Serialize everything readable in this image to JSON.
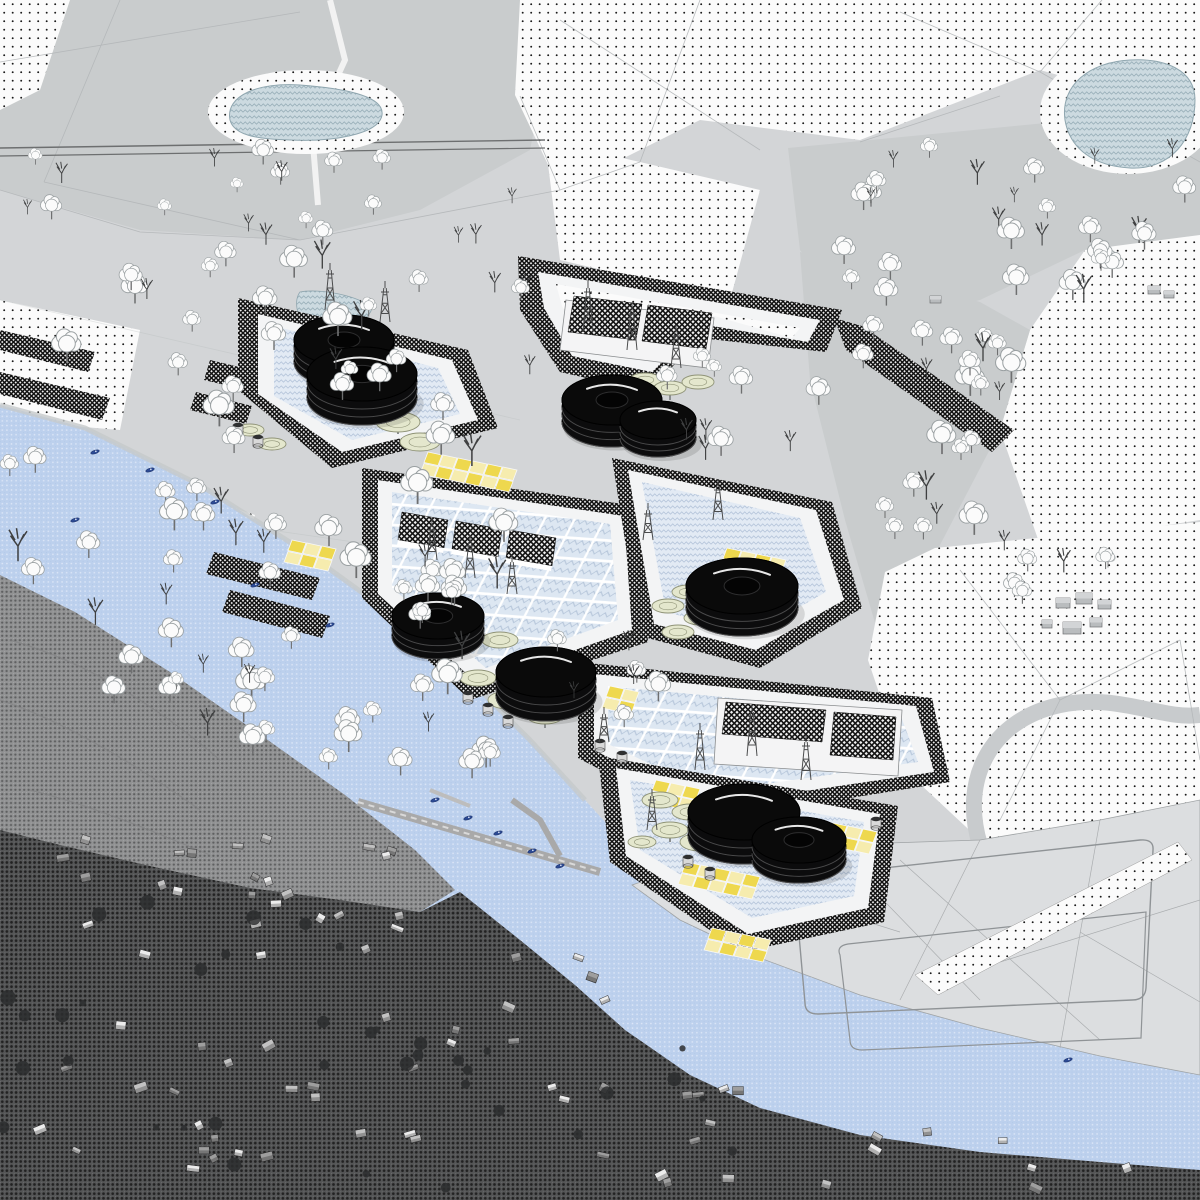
{
  "meta": {
    "kind": "architectural-masterplan-aerial-collage",
    "regions": [
      "drawn parkland with trees",
      "dotted meadow fields",
      "chevron-hatched ponds",
      "terraced process platforms with storage tanks",
      "blue overlaid river",
      "halftone aerial photograph of riverside town",
      "reclaimed polder fields with berms"
    ]
  },
  "colors": {
    "base": "#d3d5d7",
    "terrain": "#c9cccd",
    "terrainDark": "#bfc2c4",
    "field": "#dcdee0",
    "white": "#f4f4f5",
    "yellow1": "#eed84e",
    "yellow2": "#f6ecae",
    "padGreen": "#e4e7cd",
    "padStroke": "#8f9377",
    "tankBlack": "#0c0c0d",
    "boat": "#2c4a94",
    "houseLight": "#ececec",
    "houseMid": "#c2c2c2",
    "houseDark": "#9e9e9e",
    "shrub": "#2c2d2e",
    "mast": "#4b4c4d"
  },
  "scene": {
    "tree_zones": [
      {
        "x": 15,
        "y": 150,
        "w": 500,
        "h": 90,
        "n": 20,
        "bare": 0.45,
        "s": 0.75
      },
      {
        "x": 0,
        "y": 250,
        "w": 540,
        "h": 150,
        "n": 26,
        "bare": 0.3,
        "s": 1.0
      },
      {
        "x": 0,
        "y": 405,
        "w": 520,
        "h": 175,
        "n": 26,
        "bare": 0.25,
        "s": 1.1
      },
      {
        "x": 90,
        "y": 580,
        "w": 390,
        "h": 160,
        "n": 20,
        "bare": 0.3,
        "s": 1.05
      },
      {
        "x": 240,
        "y": 700,
        "w": 260,
        "h": 100,
        "n": 11,
        "bare": 0.2,
        "s": 1.0
      },
      {
        "x": 830,
        "y": 150,
        "w": 360,
        "h": 80,
        "n": 14,
        "bare": 0.5,
        "s": 0.85
      },
      {
        "x": 840,
        "y": 235,
        "w": 360,
        "h": 95,
        "n": 15,
        "bare": 0.25,
        "s": 0.95
      },
      {
        "x": 850,
        "y": 330,
        "w": 175,
        "h": 120,
        "n": 14,
        "bare": 0.2,
        "s": 1.05
      },
      {
        "x": 868,
        "y": 440,
        "w": 145,
        "h": 110,
        "n": 10,
        "bare": 0.15,
        "s": 1.05
      },
      {
        "x": 1000,
        "y": 560,
        "w": 170,
        "h": 50,
        "n": 6,
        "bare": 0.2,
        "s": 0.9
      },
      {
        "x": 660,
        "y": 360,
        "w": 170,
        "h": 95,
        "n": 10,
        "bare": 0.45,
        "s": 0.9
      },
      {
        "x": 545,
        "y": 640,
        "w": 150,
        "h": 130,
        "n": 7,
        "bare": 0.3,
        "s": 0.95
      },
      {
        "x": 150,
        "y": 640,
        "w": 120,
        "h": 90,
        "n": 6,
        "bare": 0.5,
        "s": 0.9
      }
    ],
    "tanks": [
      {
        "x": 344,
        "y": 340,
        "rx": 50,
        "ry": 25,
        "h": 22,
        "donut": true
      },
      {
        "x": 362,
        "y": 374,
        "rx": 55,
        "ry": 27,
        "h": 24,
        "donut": true
      },
      {
        "x": 612,
        "y": 400,
        "rx": 50,
        "ry": 25,
        "h": 22,
        "donut": true
      },
      {
        "x": 658,
        "y": 420,
        "rx": 38,
        "ry": 19,
        "h": 18,
        "donut": false
      },
      {
        "x": 438,
        "y": 616,
        "rx": 46,
        "ry": 23,
        "h": 20,
        "donut": true
      },
      {
        "x": 546,
        "y": 672,
        "rx": 50,
        "ry": 25,
        "h": 24,
        "donut": false
      },
      {
        "x": 742,
        "y": 586,
        "rx": 56,
        "ry": 28,
        "h": 22,
        "donut": true
      },
      {
        "x": 744,
        "y": 812,
        "rx": 56,
        "ry": 28,
        "h": 24,
        "donut": false
      },
      {
        "x": 799,
        "y": 840,
        "rx": 47,
        "ry": 23,
        "h": 20,
        "donut": true
      }
    ],
    "masts": [
      {
        "x": 330,
        "y": 310,
        "h": 40
      },
      {
        "x": 385,
        "y": 322,
        "h": 34
      },
      {
        "x": 588,
        "y": 332,
        "h": 44
      },
      {
        "x": 632,
        "y": 350,
        "h": 40
      },
      {
        "x": 676,
        "y": 368,
        "h": 36
      },
      {
        "x": 432,
        "y": 560,
        "h": 34
      },
      {
        "x": 470,
        "y": 578,
        "h": 36
      },
      {
        "x": 512,
        "y": 594,
        "h": 32
      },
      {
        "x": 648,
        "y": 540,
        "h": 30
      },
      {
        "x": 718,
        "y": 520,
        "h": 34
      },
      {
        "x": 700,
        "y": 770,
        "h": 40
      },
      {
        "x": 752,
        "y": 756,
        "h": 44
      },
      {
        "x": 806,
        "y": 780,
        "h": 38
      },
      {
        "x": 652,
        "y": 830,
        "h": 34
      },
      {
        "x": 604,
        "y": 742,
        "h": 28
      }
    ],
    "pads": [
      {
        "x": 372,
        "y": 400,
        "rx": 20,
        "ry": 9
      },
      {
        "x": 398,
        "y": 422,
        "rx": 22,
        "ry": 10
      },
      {
        "x": 420,
        "y": 442,
        "rx": 20,
        "ry": 9
      },
      {
        "x": 645,
        "y": 380,
        "rx": 16,
        "ry": 7
      },
      {
        "x": 670,
        "y": 388,
        "rx": 16,
        "ry": 7
      },
      {
        "x": 698,
        "y": 382,
        "rx": 16,
        "ry": 7
      },
      {
        "x": 500,
        "y": 640,
        "rx": 18,
        "ry": 8
      },
      {
        "x": 478,
        "y": 678,
        "rx": 18,
        "ry": 8
      },
      {
        "x": 508,
        "y": 700,
        "rx": 20,
        "ry": 9
      },
      {
        "x": 545,
        "y": 716,
        "rx": 18,
        "ry": 8
      },
      {
        "x": 688,
        "y": 592,
        "rx": 16,
        "ry": 7
      },
      {
        "x": 668,
        "y": 606,
        "rx": 16,
        "ry": 7
      },
      {
        "x": 700,
        "y": 618,
        "rx": 16,
        "ry": 7
      },
      {
        "x": 678,
        "y": 632,
        "rx": 16,
        "ry": 7
      },
      {
        "x": 660,
        "y": 800,
        "rx": 18,
        "ry": 8
      },
      {
        "x": 690,
        "y": 812,
        "rx": 18,
        "ry": 8
      },
      {
        "x": 670,
        "y": 830,
        "rx": 18,
        "ry": 8
      },
      {
        "x": 700,
        "y": 842,
        "rx": 20,
        "ry": 9
      },
      {
        "x": 642,
        "y": 842,
        "rx": 14,
        "ry": 6
      },
      {
        "x": 250,
        "y": 430,
        "rx": 14,
        "ry": 6
      },
      {
        "x": 272,
        "y": 444,
        "rx": 14,
        "ry": 6
      }
    ],
    "drums": [
      {
        "x": 468,
        "y": 700
      },
      {
        "x": 488,
        "y": 712
      },
      {
        "x": 508,
        "y": 724
      },
      {
        "x": 600,
        "y": 748
      },
      {
        "x": 622,
        "y": 760
      },
      {
        "x": 238,
        "y": 432
      },
      {
        "x": 258,
        "y": 444
      },
      {
        "x": 688,
        "y": 864
      },
      {
        "x": 710,
        "y": 876
      },
      {
        "x": 876,
        "y": 826
      }
    ],
    "yellow_patches": [
      {
        "x": 428,
        "y": 452,
        "c": 6,
        "r": 2
      },
      {
        "x": 292,
        "y": 540,
        "c": 3,
        "r": 2
      },
      {
        "x": 610,
        "y": 686,
        "c": 2,
        "r": 2
      },
      {
        "x": 727,
        "y": 548,
        "c": 4,
        "r": 2
      },
      {
        "x": 656,
        "y": 780,
        "c": 3,
        "r": 2
      },
      {
        "x": 686,
        "y": 862,
        "c": 5,
        "r": 2
      },
      {
        "x": 833,
        "y": 823,
        "c": 3,
        "r": 2
      },
      {
        "x": 712,
        "y": 928,
        "c": 4,
        "r": 2
      }
    ],
    "boats": [
      {
        "x": 95,
        "y": 452
      },
      {
        "x": 150,
        "y": 470
      },
      {
        "x": 215,
        "y": 502
      },
      {
        "x": 75,
        "y": 520
      },
      {
        "x": 255,
        "y": 585
      },
      {
        "x": 330,
        "y": 625
      },
      {
        "x": 435,
        "y": 800
      },
      {
        "x": 468,
        "y": 818
      },
      {
        "x": 498,
        "y": 833
      },
      {
        "x": 532,
        "y": 851
      },
      {
        "x": 560,
        "y": 866
      },
      {
        "x": 1068,
        "y": 1060
      }
    ],
    "house_zones": [
      {
        "x": 8,
        "y": 838,
        "w": 400,
        "h": 120,
        "n": 26
      },
      {
        "x": 30,
        "y": 980,
        "w": 360,
        "h": 190,
        "n": 20
      },
      {
        "x": 380,
        "y": 950,
        "w": 250,
        "h": 190,
        "n": 15
      },
      {
        "x": 540,
        "y": 1070,
        "w": 230,
        "h": 120,
        "n": 10
      },
      {
        "x": 800,
        "y": 1130,
        "w": 340,
        "h": 60,
        "n": 8
      }
    ],
    "shrub_zones": [
      {
        "x": 0,
        "y": 900,
        "w": 480,
        "h": 290,
        "n": 26
      },
      {
        "x": 420,
        "y": 1040,
        "w": 320,
        "h": 150,
        "n": 12
      }
    ],
    "farm_buildings": [
      {
        "x": 1056,
        "y": 598,
        "w": 14,
        "h": 10
      },
      {
        "x": 1076,
        "y": 593,
        "w": 16,
        "h": 11
      },
      {
        "x": 1098,
        "y": 600,
        "w": 13,
        "h": 9
      },
      {
        "x": 1042,
        "y": 620,
        "w": 10,
        "h": 8
      },
      {
        "x": 1063,
        "y": 622,
        "w": 18,
        "h": 12
      },
      {
        "x": 1090,
        "y": 618,
        "w": 12,
        "h": 9
      },
      {
        "x": 1148,
        "y": 286,
        "w": 12,
        "h": 8
      },
      {
        "x": 1164,
        "y": 291,
        "w": 10,
        "h": 7
      },
      {
        "x": 930,
        "y": 296,
        "w": 11,
        "h": 7
      }
    ]
  }
}
